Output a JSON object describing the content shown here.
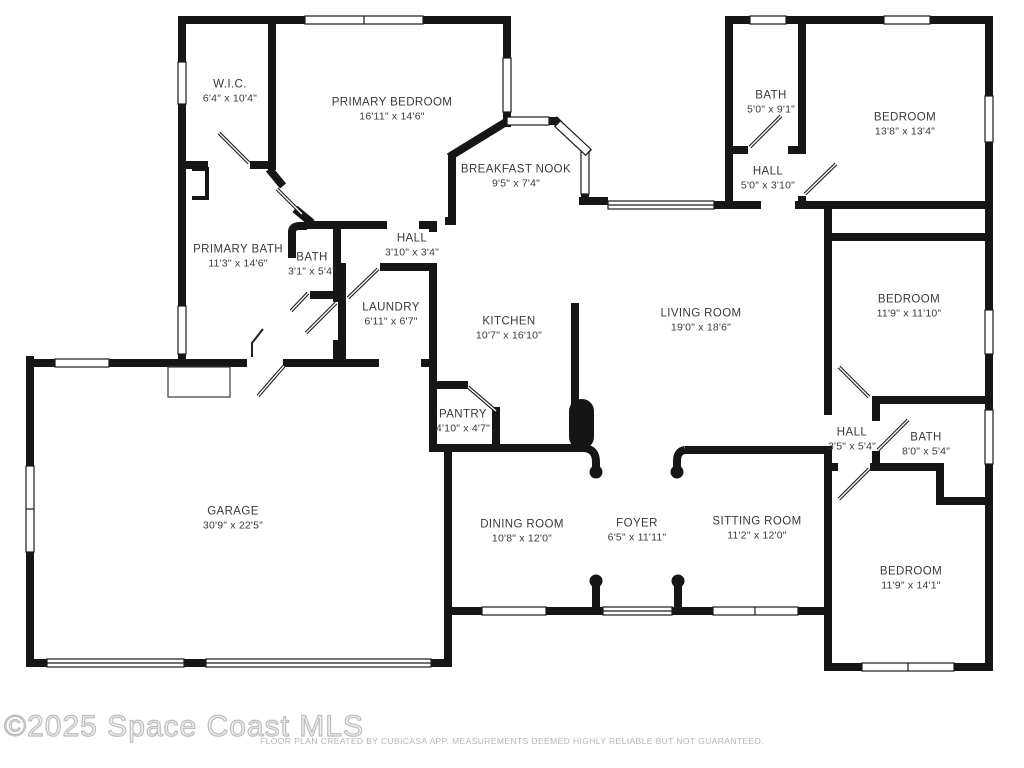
{
  "watermark": "©2025 Space Coast MLS",
  "disclaimer": "FLOOR PLAN CREATED BY CUBICASA APP. MEASUREMENTS DEEMED HIGHLY RELIABLE BUT NOT GUARANTEED.",
  "rooms": [
    {
      "slug": "wic",
      "name": "W.I.C.",
      "dims": "6'4\" x 10'4\"",
      "x": 230,
      "y": 92
    },
    {
      "slug": "primary-bedroom",
      "name": "PRIMARY BEDROOM",
      "dims": "16'11\" x 14'6\"",
      "x": 392,
      "y": 110
    },
    {
      "slug": "breakfast-nook",
      "name": "BREAKFAST NOOK",
      "dims": "9'5\" x 7'4\"",
      "x": 516,
      "y": 177
    },
    {
      "slug": "bath-north",
      "name": "BATH",
      "dims": "5'0\" x 9'1\"",
      "x": 771,
      "y": 103
    },
    {
      "slug": "hall-north",
      "name": "HALL",
      "dims": "5'0\" x 3'10\"",
      "x": 768,
      "y": 179
    },
    {
      "slug": "bedroom-northeast",
      "name": "BEDROOM",
      "dims": "13'8\" x 13'4\"",
      "x": 905,
      "y": 125
    },
    {
      "slug": "primary-bath",
      "name": "PRIMARY BATH",
      "dims": "11'3\" x 14'6\"",
      "x": 238,
      "y": 257
    },
    {
      "slug": "bath-suite",
      "name": "BATH",
      "dims": "3'1\" x 5'4\"",
      "x": 312,
      "y": 265
    },
    {
      "slug": "hall-suite",
      "name": "HALL",
      "dims": "3'10\" x 3'4\"",
      "x": 412,
      "y": 246
    },
    {
      "slug": "laundry",
      "name": "LAUNDRY",
      "dims": "6'11\" x 6'7\"",
      "x": 391,
      "y": 315
    },
    {
      "slug": "kitchen",
      "name": "KITCHEN",
      "dims": "10'7\" x 16'10\"",
      "x": 509,
      "y": 329
    },
    {
      "slug": "living-room",
      "name": "LIVING ROOM",
      "dims": "19'0\" x 18'6\"",
      "x": 701,
      "y": 321
    },
    {
      "slug": "bedroom-east",
      "name": "BEDROOM",
      "dims": "11'9\" x 11'10\"",
      "x": 909,
      "y": 307
    },
    {
      "slug": "pantry",
      "name": "PANTRY",
      "dims": "4'10\" x 4'7\"",
      "x": 463,
      "y": 422
    },
    {
      "slug": "hall-east",
      "name": "HALL",
      "dims": "3'5\" x 5'4\"",
      "x": 852,
      "y": 440
    },
    {
      "slug": "bath-east",
      "name": "BATH",
      "dims": "8'0\" x 5'4\"",
      "x": 926,
      "y": 445
    },
    {
      "slug": "garage",
      "name": "GARAGE",
      "dims": "30'9\" x 22'5\"",
      "x": 233,
      "y": 519
    },
    {
      "slug": "dining-room",
      "name": "DINING ROOM",
      "dims": "10'8\" x 12'0\"",
      "x": 522,
      "y": 532
    },
    {
      "slug": "foyer",
      "name": "FOYER",
      "dims": "6'5\" x 11'11\"",
      "x": 637,
      "y": 531
    },
    {
      "slug": "sitting-room",
      "name": "SITTING ROOM",
      "dims": "11'2\" x 12'0\"",
      "x": 757,
      "y": 529
    },
    {
      "slug": "bedroom-southeast",
      "name": "BEDROOM",
      "dims": "11'9\" x 14'1\"",
      "x": 911,
      "y": 579
    }
  ]
}
